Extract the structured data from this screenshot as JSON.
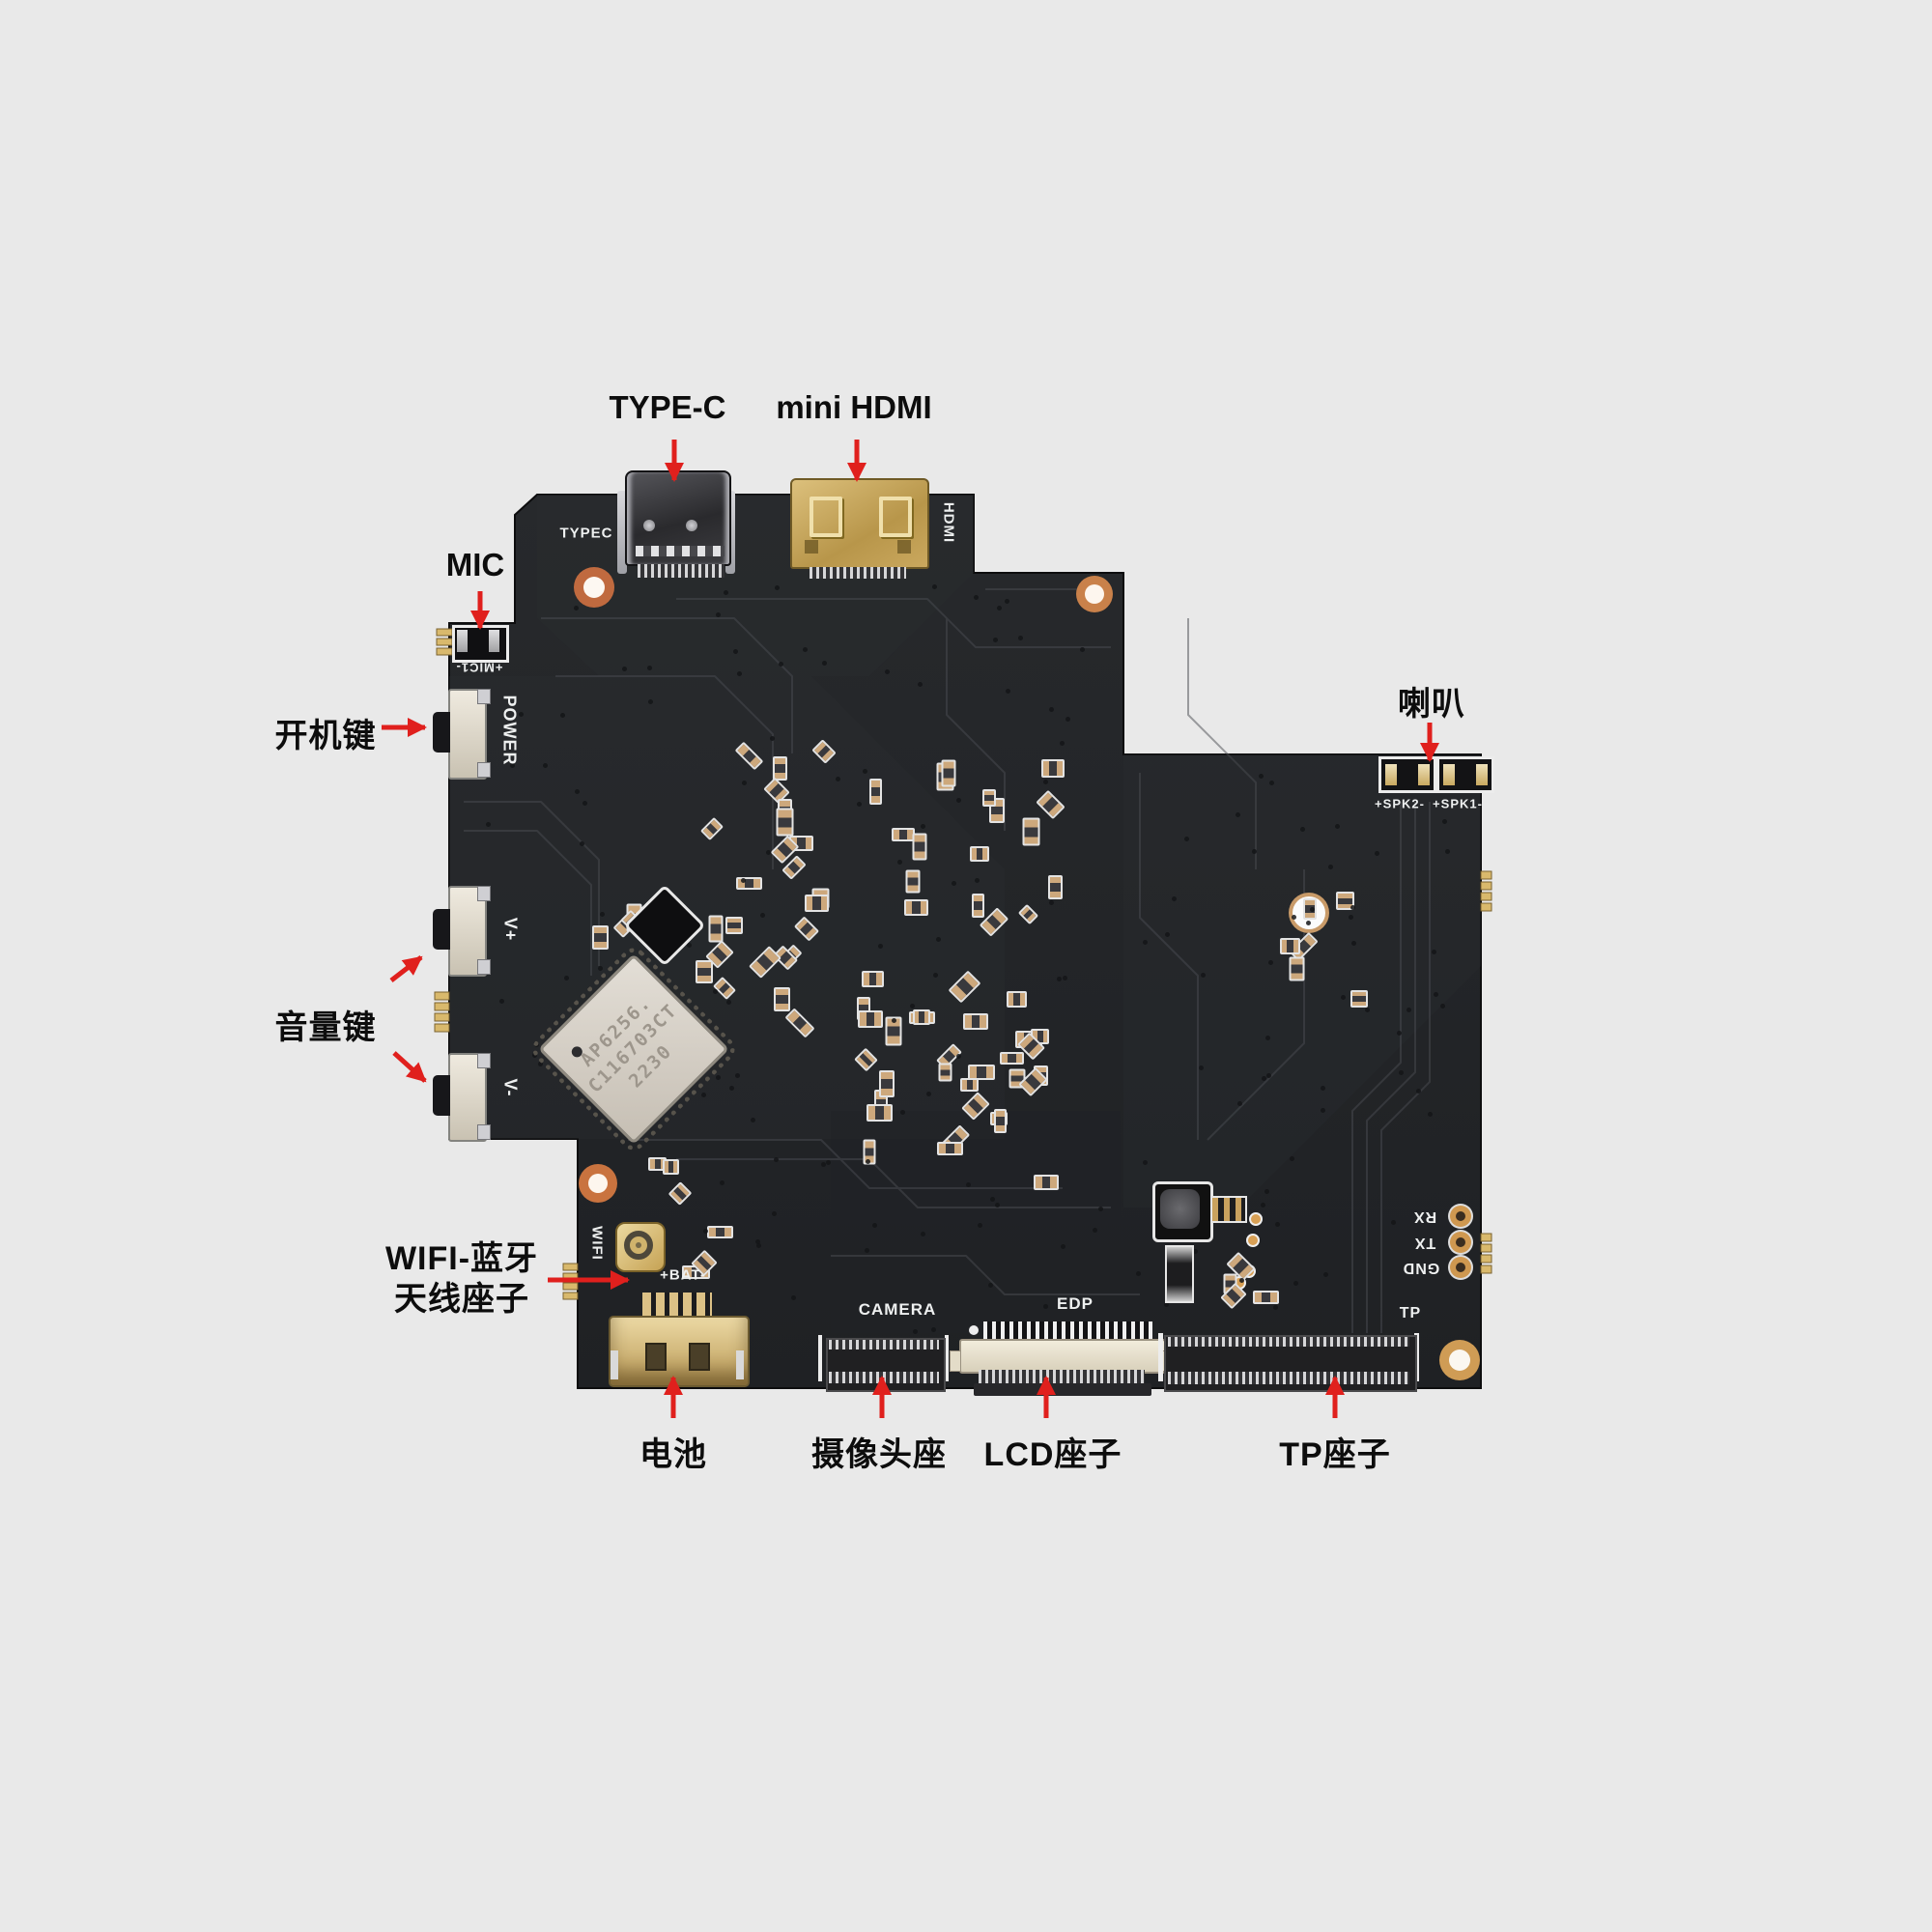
{
  "callouts": {
    "typec": {
      "label": "TYPE-C"
    },
    "mini_hdmi": {
      "label": "mini HDMI"
    },
    "mic": {
      "label": "MIC"
    },
    "power_key": {
      "label": "开机键"
    },
    "volume_key": {
      "label": "音量键"
    },
    "wifi_antenna": {
      "line1": "WIFI-蓝牙",
      "line2": "天线座子"
    },
    "battery": {
      "label": "电池"
    },
    "camera": {
      "label": "摄像头座"
    },
    "lcd": {
      "label": "LCD座子"
    },
    "tp": {
      "label": "TP座子"
    },
    "speaker": {
      "label": "喇叭"
    }
  },
  "silkscreen": {
    "typec": "TYPEC",
    "hdmi": "HDMI",
    "mic": "+MIC1-",
    "power": "POWER",
    "v_plus": "V+",
    "v_minus": "V-",
    "wifi": "WIFI",
    "bat": "+BAT-",
    "camera": "CAMERA",
    "edp": "EDP",
    "tp": "TP",
    "rx": "RX",
    "tx": "TX",
    "gnd": "GND",
    "spk2": "+SPK2-",
    "spk1": "+SPK1-"
  },
  "module": {
    "line1": "AP6256.",
    "line2": "C116703CT",
    "line3": "2230"
  },
  "colors": {
    "background": "#e9e9e9",
    "board": "#242628",
    "arrow": "#e0201d",
    "silkscreen": "#eef0f0",
    "gold": "#d5b269",
    "label_text": "#0d0d0d"
  }
}
